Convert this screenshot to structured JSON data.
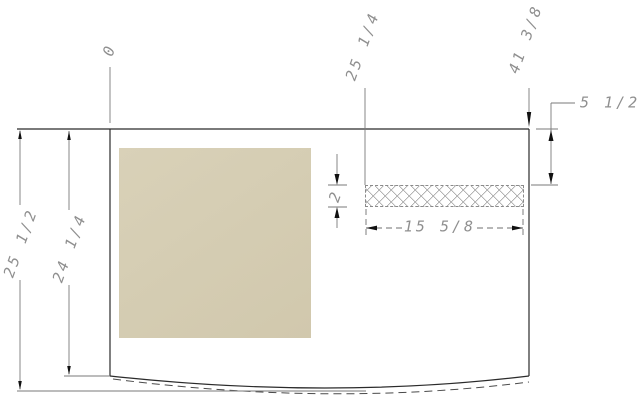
{
  "page": {
    "kind": "CAD dimensioned section drawing",
    "background": "#ffffff"
  },
  "colors": {
    "outline": "#2b2b2b",
    "dimension_line": "#767676",
    "dimension_text": "#8f8f8f",
    "arrow": "#111111",
    "swatch": "#d6ceb4",
    "hatch_line": "#9c9c9c"
  },
  "labels": {
    "datum_zero": "0",
    "top_position_mid": "25 1/4",
    "top_position_right": "41 3/8",
    "right_inset_depth": "5 1/2",
    "strip_thickness": "2",
    "strip_length": "15 5/8",
    "overall_left_height": "25 1/2",
    "inner_left_height": "24 1/4"
  }
}
